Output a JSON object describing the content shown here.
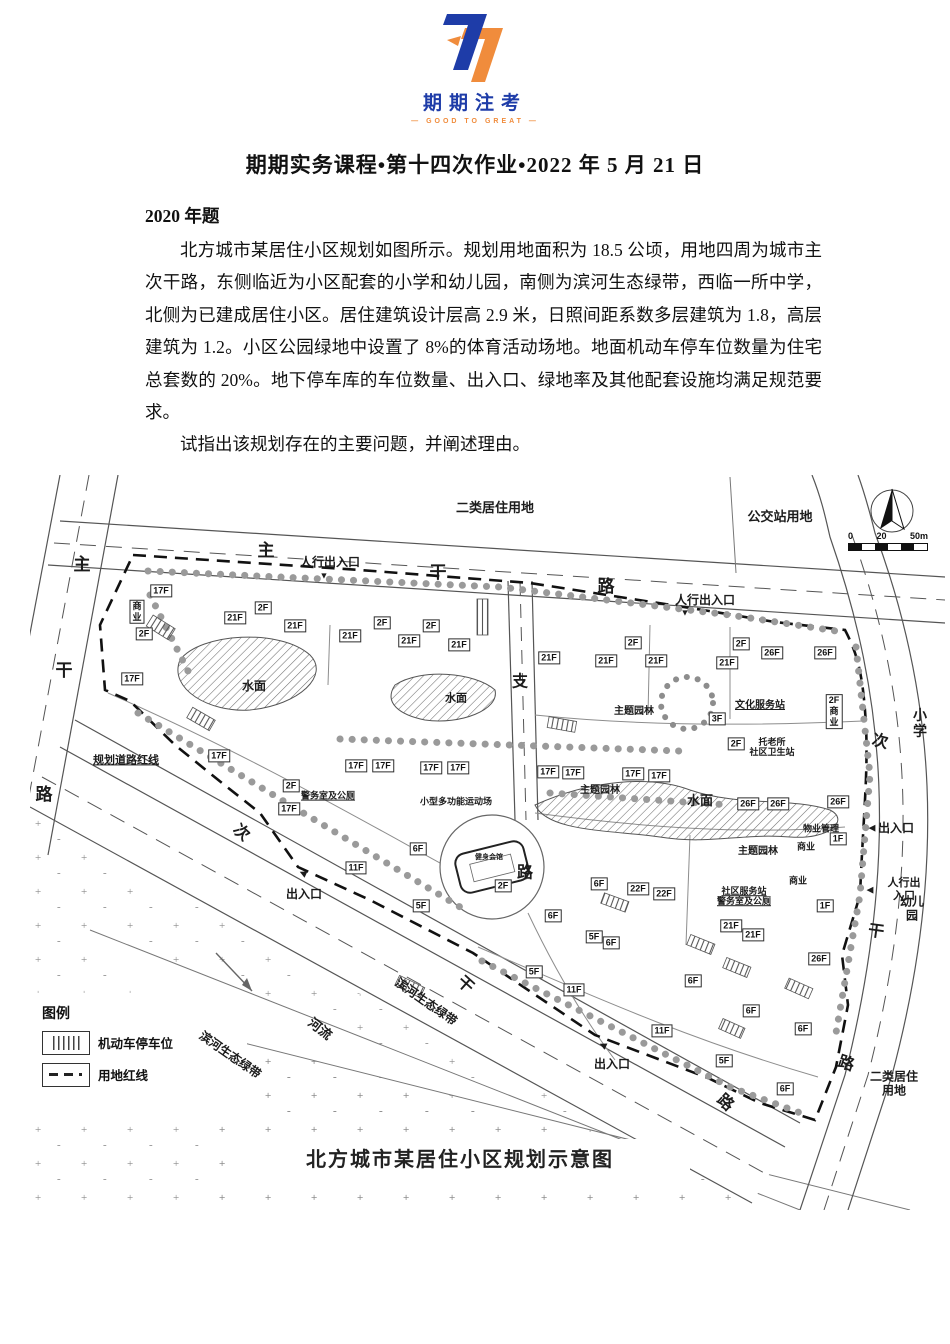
{
  "logo": {
    "brand": "期期注考",
    "tagline": "— GOOD TO GREAT —",
    "accent_blue": "#1e3ca8",
    "accent_orange": "#f08c3c"
  },
  "document": {
    "title": "期期实务课程•第十四次作业•2022 年 5 月 21 日",
    "section_heading": "2020 年题",
    "paragraph": "北方城市某居住小区规划如图所示。规划用地面积为 18.5 公顷，用地四周为城市主次干路，东侧临近为小区配套的小学和幼儿园，南侧为滨河生态绿带，西临一所中学，北侧为已建成居住小区。居住建筑设计层高 2.9 米，日照间距系数多层建筑为 1.8，高层建筑为 1.2。小区公园绿地中设置了 8%的体育活动场地。地面机动车停车位数量为住宅总套数的 20%。地下停车库的车位数量、出入口、绿地率及其他配套设施均满足规范要求。",
    "question": "试指出该规划存在的主要问题，并阐述理由。"
  },
  "map": {
    "caption": "北方城市某居住小区规划示意图",
    "scale": [
      "0",
      "20",
      "50m"
    ],
    "legend": {
      "title": "图例",
      "items": [
        "机动车停车位",
        "用地红线"
      ]
    },
    "labels": [
      {
        "t": "主",
        "x": 52,
        "y": 90,
        "s": 17,
        "n": "road-label-west-main"
      },
      {
        "t": "干",
        "x": 34,
        "y": 196,
        "s": 17,
        "n": "road-label-west-main"
      },
      {
        "t": "路",
        "x": 14,
        "y": 320,
        "s": 17,
        "n": "road-label-west-main"
      },
      {
        "t": "主",
        "x": 236,
        "y": 76,
        "s": 17,
        "n": "road-label-north-main"
      },
      {
        "t": "干",
        "x": 408,
        "y": 98,
        "s": 17,
        "n": "road-label-north-main"
      },
      {
        "t": "路",
        "x": 576,
        "y": 112,
        "s": 17,
        "n": "road-label-north-main"
      },
      {
        "t": "支",
        "x": 490,
        "y": 207,
        "s": 16,
        "n": "road-label-branch"
      },
      {
        "t": "路",
        "x": 495,
        "y": 398,
        "s": 16,
        "n": "road-label-branch"
      },
      {
        "t": "次",
        "x": 211,
        "y": 358,
        "s": 16,
        "r": 42,
        "n": "road-label-south-secondary"
      },
      {
        "t": "干",
        "x": 435,
        "y": 510,
        "s": 16,
        "r": 42,
        "n": "road-label-south-secondary"
      },
      {
        "t": "路",
        "x": 695,
        "y": 628,
        "s": 16,
        "r": 42,
        "n": "road-label-south-secondary"
      },
      {
        "t": "次",
        "x": 850,
        "y": 267,
        "s": 16,
        "r": 14,
        "n": "road-label-east-secondary"
      },
      {
        "t": "干",
        "x": 846,
        "y": 457,
        "s": 16,
        "r": 8,
        "n": "road-label-east-secondary"
      },
      {
        "t": "路",
        "x": 816,
        "y": 589,
        "s": 16,
        "r": 18,
        "n": "road-label-east-secondary"
      },
      {
        "t": "二类居住用地",
        "x": 465,
        "y": 33,
        "s": 13,
        "n": "adjacent-landuse-label"
      },
      {
        "t": "公交站用地",
        "x": 750,
        "y": 42,
        "s": 13,
        "n": "adjacent-landuse-label"
      },
      {
        "t": "小学",
        "x": 890,
        "y": 249,
        "s": 14,
        "n": "adjacent-landuse-label"
      },
      {
        "t": "幼儿园",
        "x": 882,
        "y": 434,
        "s": 12,
        "n": "adjacent-landuse-label"
      },
      {
        "t": "二类居住用地",
        "x": 864,
        "y": 609,
        "s": 12,
        "n": "adjacent-landuse-label"
      },
      {
        "t": "河流",
        "x": 290,
        "y": 554,
        "s": 13,
        "r": 38,
        "n": "river-label"
      },
      {
        "t": "滨河生态绿带",
        "x": 396,
        "y": 527,
        "s": 12,
        "r": 35,
        "n": "greenbelt-label"
      },
      {
        "t": "滨河生态绿带",
        "x": 200,
        "y": 580,
        "s": 12,
        "r": 35,
        "n": "greenbelt-label"
      },
      {
        "t": "人行出入口",
        "x": 300,
        "y": 87,
        "s": 12,
        "n": "pedestrian-entrance-label"
      },
      {
        "t": "▼",
        "x": 294,
        "y": 101,
        "s": 9,
        "n": "entrance-arrow-icon"
      },
      {
        "t": "人行出入口",
        "x": 675,
        "y": 125,
        "s": 12,
        "n": "pedestrian-entrance-label"
      },
      {
        "t": "▼",
        "x": 655,
        "y": 138,
        "s": 9,
        "n": "entrance-arrow-icon"
      },
      {
        "t": "出入口",
        "x": 274,
        "y": 419,
        "s": 12,
        "n": "vehicle-entrance-label"
      },
      {
        "t": "◀",
        "x": 273,
        "y": 398,
        "s": 9,
        "r": 25,
        "n": "entrance-arrow-icon"
      },
      {
        "t": "出入口",
        "x": 582,
        "y": 589,
        "s": 12,
        "n": "vehicle-entrance-label"
      },
      {
        "t": "◀",
        "x": 573,
        "y": 570,
        "s": 9,
        "r": 25,
        "n": "entrance-arrow-icon"
      },
      {
        "t": "出入口",
        "x": 866,
        "y": 353,
        "s": 12,
        "n": "vehicle-entrance-label"
      },
      {
        "t": "◀",
        "x": 842,
        "y": 353,
        "s": 9,
        "n": "entrance-arrow-icon"
      },
      {
        "t": "人行出入口",
        "x": 874,
        "y": 415,
        "s": 11,
        "n": "pedestrian-entrance-label"
      },
      {
        "t": "◀",
        "x": 840,
        "y": 415,
        "s": 9,
        "n": "entrance-arrow-icon"
      },
      {
        "t": "规划道路红线",
        "x": 96,
        "y": 286,
        "s": 11,
        "u": 1,
        "n": "red-line-label"
      },
      {
        "t": "水面",
        "x": 224,
        "y": 211,
        "s": 12,
        "n": "water-label"
      },
      {
        "t": "水面",
        "x": 426,
        "y": 224,
        "s": 11,
        "n": "water-label"
      },
      {
        "t": "水面",
        "x": 670,
        "y": 326,
        "s": 13,
        "n": "water-label"
      },
      {
        "t": "主题园林",
        "x": 604,
        "y": 237,
        "s": 10,
        "n": "garden-label"
      },
      {
        "t": "主题园林",
        "x": 570,
        "y": 316,
        "s": 10,
        "n": "garden-label"
      },
      {
        "t": "主题园林",
        "x": 728,
        "y": 377,
        "s": 10,
        "n": "garden-label"
      },
      {
        "t": "文化服务站",
        "x": 730,
        "y": 231,
        "s": 10,
        "u": 1,
        "n": "facility-label"
      },
      {
        "t": "托老所\n社区卫生站",
        "x": 742,
        "y": 273,
        "s": 9,
        "n": "facility-label"
      },
      {
        "t": "警务室及公厕",
        "x": 298,
        "y": 321,
        "s": 9,
        "u": 1,
        "n": "facility-label"
      },
      {
        "t": "小型多功能运动场",
        "x": 426,
        "y": 327,
        "s": 9,
        "n": "facility-label"
      },
      {
        "t": "健身会馆",
        "x": 459,
        "y": 383,
        "s": 7,
        "n": "facility-label"
      },
      {
        "t": "物业管理",
        "x": 791,
        "y": 354,
        "s": 9,
        "n": "facility-label"
      },
      {
        "t": "商业",
        "x": 776,
        "y": 372,
        "s": 9,
        "n": "facility-label"
      },
      {
        "t": "商业",
        "x": 768,
        "y": 406,
        "s": 9,
        "n": "facility-label"
      },
      {
        "t": "社区服务站\n警务室及公厕",
        "x": 714,
        "y": 422,
        "s": 9,
        "u": 1,
        "n": "facility-label"
      }
    ],
    "buildings": [
      {
        "t": "17F",
        "x": 131,
        "y": 116
      },
      {
        "t": "商\n业",
        "x": 107,
        "y": 137
      },
      {
        "t": "2F",
        "x": 114,
        "y": 159
      },
      {
        "t": "17F",
        "x": 102,
        "y": 204
      },
      {
        "t": "21F",
        "x": 205,
        "y": 143
      },
      {
        "t": "2F",
        "x": 233,
        "y": 133
      },
      {
        "t": "21F",
        "x": 265,
        "y": 151
      },
      {
        "t": "21F",
        "x": 320,
        "y": 161
      },
      {
        "t": "2F",
        "x": 352,
        "y": 148
      },
      {
        "t": "21F",
        "x": 379,
        "y": 166
      },
      {
        "t": "2F",
        "x": 401,
        "y": 151
      },
      {
        "t": "21F",
        "x": 429,
        "y": 170
      },
      {
        "t": "21F",
        "x": 519,
        "y": 183
      },
      {
        "t": "21F",
        "x": 576,
        "y": 186
      },
      {
        "t": "2F",
        "x": 603,
        "y": 168
      },
      {
        "t": "21F",
        "x": 626,
        "y": 186
      },
      {
        "t": "21F",
        "x": 697,
        "y": 188
      },
      {
        "t": "2F",
        "x": 711,
        "y": 169
      },
      {
        "t": "26F",
        "x": 742,
        "y": 178
      },
      {
        "t": "26F",
        "x": 795,
        "y": 178
      },
      {
        "t": "17F",
        "x": 189,
        "y": 281
      },
      {
        "t": "2F",
        "x": 261,
        "y": 311
      },
      {
        "t": "17F",
        "x": 259,
        "y": 334
      },
      {
        "t": "17F",
        "x": 326,
        "y": 291
      },
      {
        "t": "17F",
        "x": 353,
        "y": 291
      },
      {
        "t": "17F",
        "x": 401,
        "y": 293
      },
      {
        "t": "17F",
        "x": 428,
        "y": 293
      },
      {
        "t": "17F",
        "x": 518,
        "y": 297
      },
      {
        "t": "17F",
        "x": 543,
        "y": 298
      },
      {
        "t": "17F",
        "x": 603,
        "y": 299
      },
      {
        "t": "17F",
        "x": 629,
        "y": 301
      },
      {
        "t": "3F",
        "x": 687,
        "y": 244
      },
      {
        "t": "2F",
        "x": 706,
        "y": 269
      },
      {
        "t": "2F\n商\n业",
        "x": 804,
        "y": 237
      },
      {
        "t": "26F",
        "x": 718,
        "y": 329
      },
      {
        "t": "26F",
        "x": 748,
        "y": 329
      },
      {
        "t": "26F",
        "x": 808,
        "y": 327
      },
      {
        "t": "1F",
        "x": 808,
        "y": 364
      },
      {
        "t": "1F",
        "x": 795,
        "y": 431
      },
      {
        "t": "11F",
        "x": 326,
        "y": 393
      },
      {
        "t": "6F",
        "x": 388,
        "y": 374
      },
      {
        "t": "2F",
        "x": 473,
        "y": 411
      },
      {
        "t": "5F",
        "x": 391,
        "y": 431
      },
      {
        "t": "6F",
        "x": 569,
        "y": 409
      },
      {
        "t": "22F",
        "x": 608,
        "y": 414
      },
      {
        "t": "22F",
        "x": 634,
        "y": 419
      },
      {
        "t": "6F",
        "x": 523,
        "y": 441
      },
      {
        "t": "5F",
        "x": 564,
        "y": 462
      },
      {
        "t": "6F",
        "x": 581,
        "y": 468
      },
      {
        "t": "5F",
        "x": 504,
        "y": 497
      },
      {
        "t": "11F",
        "x": 544,
        "y": 515
      },
      {
        "t": "21F",
        "x": 701,
        "y": 451
      },
      {
        "t": "21F",
        "x": 723,
        "y": 460
      },
      {
        "t": "6F",
        "x": 663,
        "y": 506
      },
      {
        "t": "26F",
        "x": 789,
        "y": 484
      },
      {
        "t": "6F",
        "x": 721,
        "y": 536
      },
      {
        "t": "11F",
        "x": 632,
        "y": 556
      },
      {
        "t": "6F",
        "x": 773,
        "y": 554
      },
      {
        "t": "5F",
        "x": 694,
        "y": 586
      },
      {
        "t": "6F",
        "x": 755,
        "y": 614
      }
    ]
  }
}
